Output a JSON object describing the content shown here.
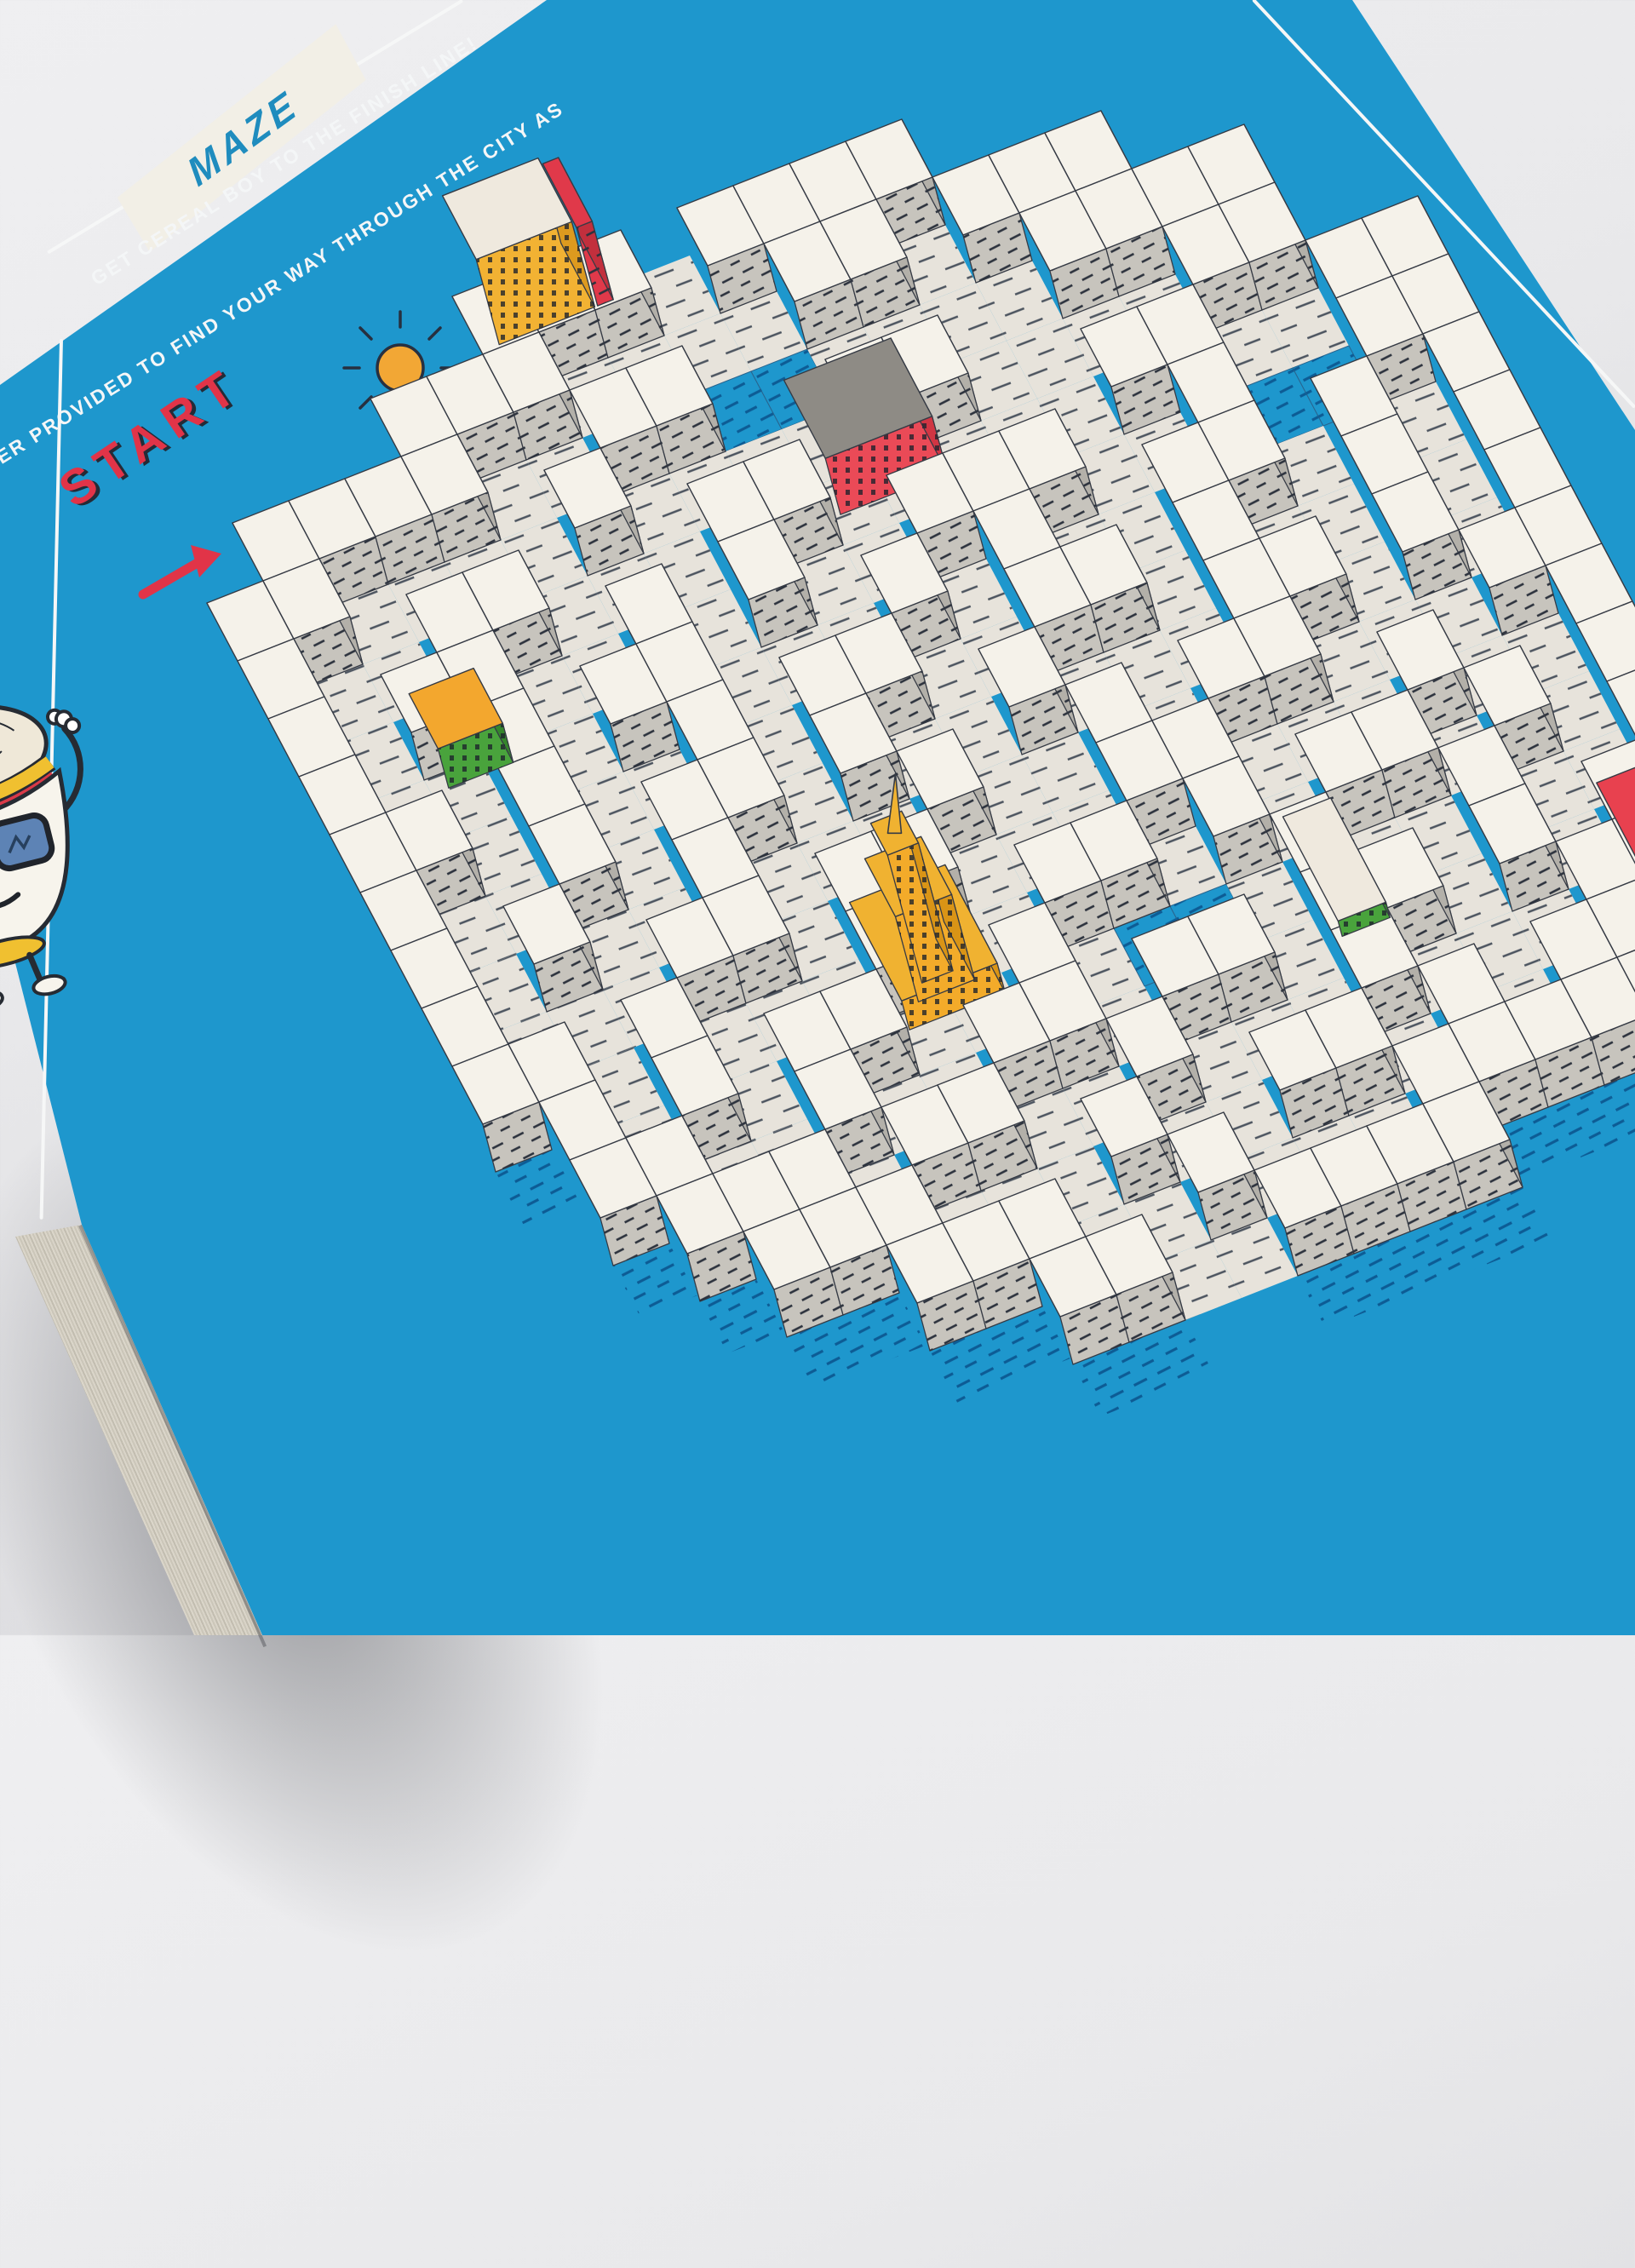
{
  "badge": {
    "label": "MAZE"
  },
  "instructions": {
    "line1": "GET CEREAL BOY TO THE FINISH LINE!",
    "line2": "RKER PROVIDED TO FIND YOUR WAY THROUGH THE CITY AS"
  },
  "start_label": "START",
  "icons": [
    "sun-icon",
    "cloud-icon",
    "bird-icon",
    "start-arrow-icon",
    "cereal-boy-character",
    "sunglasses-icon"
  ],
  "colors": {
    "box_blue": "#1e97cd",
    "background_grey": "#e9e9eb",
    "wall_top_white": "#f5f2ea",
    "wall_side_grey": "#c7c4bd",
    "wall_side_dark": "#b3b0a9",
    "floor_cream": "#e7e3db",
    "hatch_dark": "#2e3540",
    "accent_red": "#e13448",
    "badge_text_blue": "#1f8cbe",
    "sun_orange": "#f2a735",
    "building_yellow": "#f2b233",
    "building_green": "#3f9e38"
  },
  "maze": {
    "origin": [
      150,
      560
    ],
    "u": [
      66,
      -26
    ],
    "v": [
      36,
      68
    ],
    "wall_h": 56,
    "grid": [
      "      ###.####       ",
      "    ###....##.###    ",
      " ####..##bb....####  ",
      "##....#....##....## ",
      "#..##...##.....##..##",
      "#.##..#.#..###..#bb##",
      "#..#.##...#.#..##.#.#",
      "##.#..#.##..##.#..#.#",
      "#..#.##.#..#...##.#.#",
      "#.#..#...#..#.##...##",
      "#...##.##...##...#..#",
      "##.#...#..##.#.##.#.#",
      " #.#.##..#.bb.#..#..#",
      " ##..#..##.##.##.#.##",
      "  ###.##..#...#...## ",
      "   ###...#..##.#.### ",
      "     ###..#...#####  ",
      "       ##..####      "
    ],
    "colors": {
      "top": "#f5f2ea",
      "sw": "#c7c4bd",
      "se": "#b3b0a9",
      "floor": "#e7e3db",
      "blue": "#1e97cd",
      "stroke": "#363b45"
    },
    "buildings": [
      {
        "name": "yellow-building",
        "type": "block",
        "r": -0.9,
        "c": 6.5,
        "w": 1.7,
        "d": 1.1,
        "h": 100,
        "top": "#efe9de",
        "sw": "#f2b233",
        "se": "#dd9a1f",
        "windows": true
      },
      {
        "name": "yellow-building-red-trim",
        "type": "block",
        "r": -0.9,
        "c": 8.25,
        "w": 0.28,
        "d": 1.1,
        "h": 92,
        "top": "#e0394a",
        "sw": "#e0394a",
        "se": "#c22f3d",
        "windows": false
      },
      {
        "name": "red-building",
        "type": "block",
        "r": 3.2,
        "c": 10.2,
        "w": 1.9,
        "d": 1.35,
        "h": 66,
        "top": "#8e8b85",
        "sw": "#ea4a57",
        "se": "#d03543",
        "windows": true
      },
      {
        "name": "green-building",
        "type": "block",
        "r": 5.3,
        "c": 2.3,
        "w": 1.15,
        "d": 0.95,
        "h": 46,
        "top": "#f3a72e",
        "sw": "#49a33c",
        "se": "#35862c",
        "windows": true
      },
      {
        "name": "empire-tower",
        "type": "tower",
        "r": 10.6,
        "c": 7.2,
        "top": "#f0b231",
        "sw": "#f3ab2a",
        "se": "#d99416",
        "windows": true
      },
      {
        "name": "green-slab",
        "type": "block",
        "r": 11.6,
        "c": 14.3,
        "w": 0.85,
        "d": 1.8,
        "h": 18,
        "top": "#efe9de",
        "sw": "#49a33c",
        "se": "#35862c",
        "windows": true
      },
      {
        "name": "red-slab",
        "type": "block",
        "r": 12.8,
        "c": 19.2,
        "w": 1.1,
        "d": 2.4,
        "h": 12,
        "top": "#e8414f",
        "sw": "#c22f3d",
        "se": "#d03543",
        "windows": false
      }
    ]
  }
}
